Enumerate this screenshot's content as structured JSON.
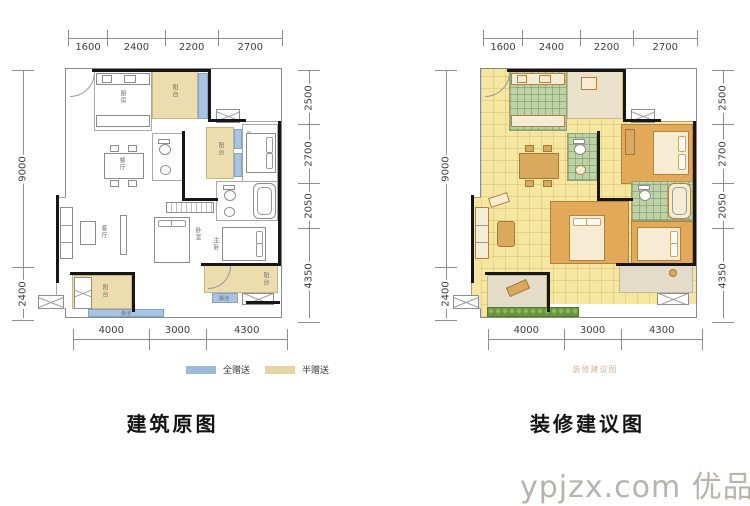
{
  "captions": {
    "left": "建筑原图",
    "right": "装修建议图"
  },
  "dims": {
    "top": [
      "1600",
      "2400",
      "2200",
      "2700"
    ],
    "left": [
      "9000",
      "2400"
    ],
    "right": [
      "2500",
      "2700",
      "2050",
      "4350"
    ],
    "bottom": [
      "4000",
      "3000",
      "4300"
    ]
  },
  "legend": {
    "full": {
      "label": "全赠送",
      "color": "#9db9d8"
    },
    "half": {
      "label": "半赠送",
      "color": "#e6d6a6"
    }
  },
  "rooms": {
    "kitchen": "厨房",
    "dining": "餐厅",
    "living": "客厅",
    "bedroom": "卧室",
    "master": "主卧",
    "bath": "卫生间",
    "balcony": "阳台",
    "bay": "飘池"
  },
  "right_plan": {
    "inner_mark": "装修建议图"
  },
  "watermark": {
    "text": "ypjzx.com 优品家",
    "color": "#b7b3ad"
  }
}
